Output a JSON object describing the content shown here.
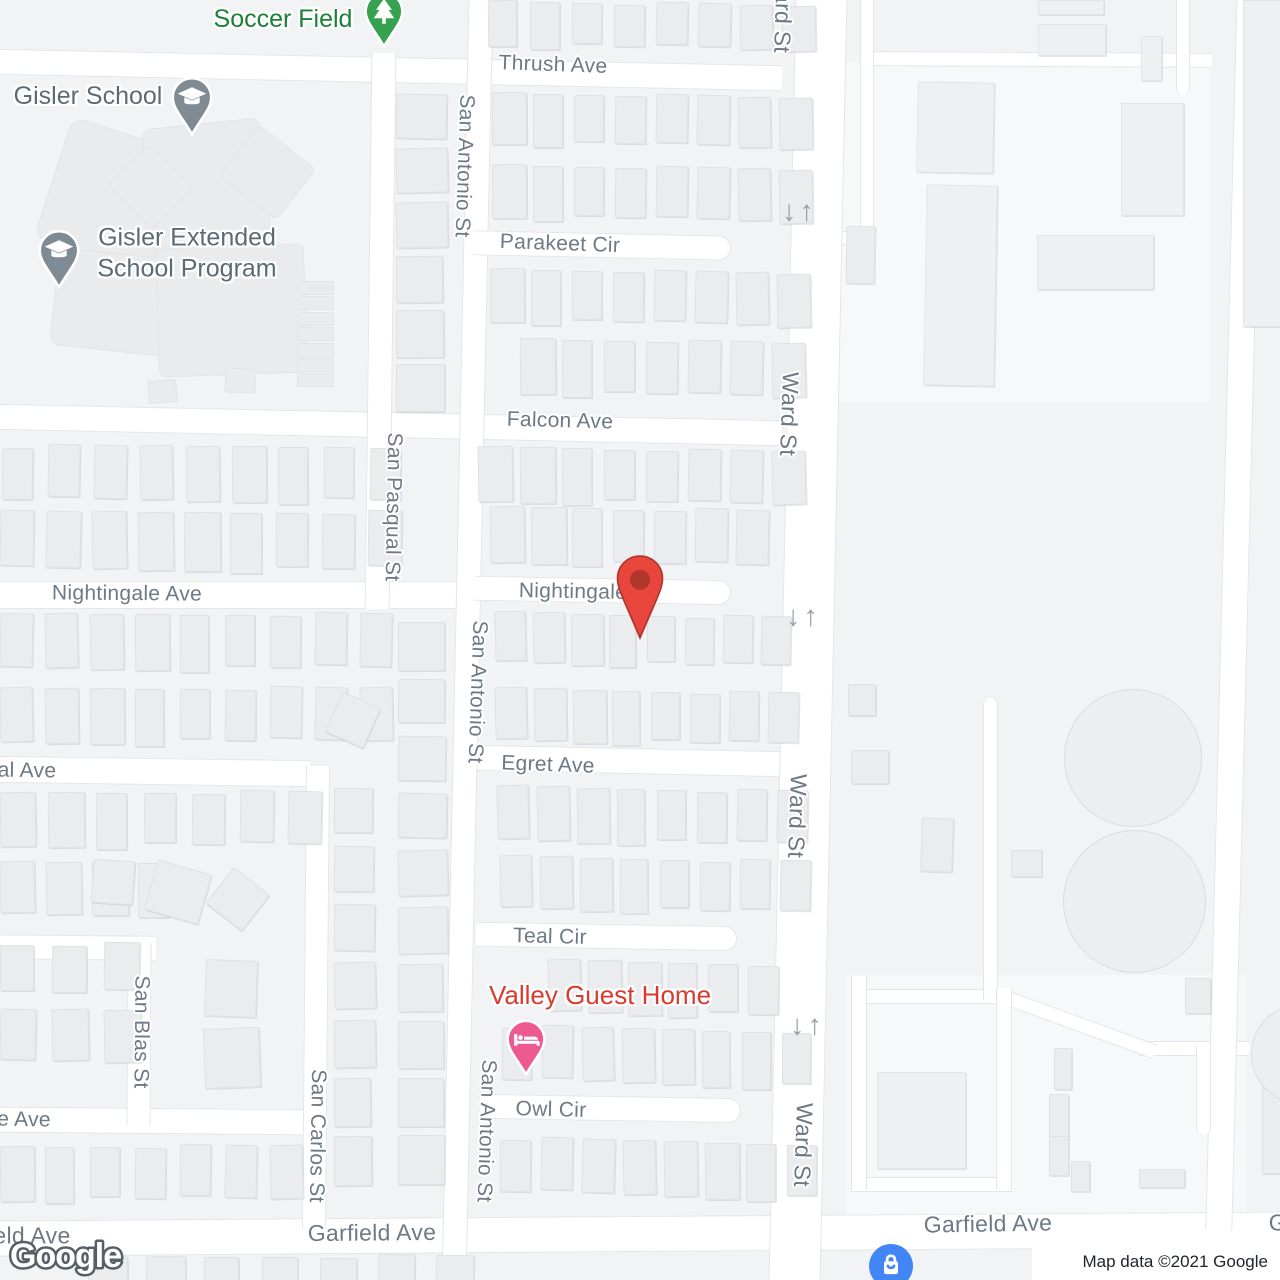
{
  "attribution": "Map data ©2021 Google",
  "watermark": "Google",
  "colors": {
    "land": "#f1f3f5",
    "road": "#ffffff",
    "road_casing": "#e3e6ea",
    "building": "#eaecee",
    "street_label": "#6d7985",
    "park_text": "#1e8038",
    "school_text": "#5b6b76",
    "lodging_text": "#d93a2e",
    "pin_park": "#36a24f",
    "pin_school": "#7e8a94",
    "pin_lodging": "#ec5a90",
    "pin_destination": "#e8453c",
    "pin_destination_inner": "#b0352b",
    "shopping_blue": "#4285f4",
    "arrow": "#9aa0a6"
  },
  "streets": [
    {
      "id": "thrush-ave",
      "text": "Thrush Ave"
    },
    {
      "id": "parakeet-cir",
      "text": "Parakeet Cir"
    },
    {
      "id": "falcon-ave",
      "text": "Falcon Ave"
    },
    {
      "id": "nightingale-ave-west",
      "text": "Nightingale Ave"
    },
    {
      "id": "nightingale-ave-east",
      "text": "Nightingale"
    },
    {
      "id": "egret-ave",
      "text": "Egret Ave"
    },
    {
      "id": "teal-cir",
      "text": "Teal Cir"
    },
    {
      "id": "owl-cir",
      "text": "Owl Cir"
    },
    {
      "id": "al-ave-clipped",
      "text": "al Ave"
    },
    {
      "id": "e-ave-clipped",
      "text": "e Ave"
    },
    {
      "id": "garfield-ave-west-clipped",
      "text": "eld Ave"
    },
    {
      "id": "garfield-ave-center",
      "text": "Garfield Ave"
    },
    {
      "id": "garfield-ave-east",
      "text": "Garfield Ave"
    },
    {
      "id": "garfield-ave-right-clipped",
      "text": "Garfield Ave"
    },
    {
      "id": "san-antonio-st-1",
      "text": "San Antonio St"
    },
    {
      "id": "san-antonio-st-2",
      "text": "San Antonio St"
    },
    {
      "id": "san-antonio-st-3",
      "text": "San Antonio St"
    },
    {
      "id": "san-pasqual-st",
      "text": "San Pasqual St"
    },
    {
      "id": "san-blas-st",
      "text": "San Blas St"
    },
    {
      "id": "san-carlos-st",
      "text": "San Carlos St"
    },
    {
      "id": "ward-st-1",
      "text": "Ward St"
    },
    {
      "id": "ward-st-2",
      "text": "Ward St"
    },
    {
      "id": "ward-st-3",
      "text": "Ward St"
    },
    {
      "id": "ward-st-4",
      "text": "Ward St"
    }
  ],
  "pois": [
    {
      "id": "soccer-field",
      "label": "Soccer Field",
      "icon": "tree-icon",
      "type": "park"
    },
    {
      "id": "gisler-school",
      "label": "Gisler School",
      "icon": "school-icon",
      "type": "school"
    },
    {
      "id": "gisler-extended-school-program",
      "label": "Gisler Extended School Program",
      "icon": "school-icon",
      "type": "school"
    },
    {
      "id": "valley-guest-home",
      "label": "Valley Guest Home",
      "icon": "lodging-icon",
      "type": "lodging"
    },
    {
      "id": "destination",
      "label": "",
      "icon": "destination-pin-icon",
      "type": "destination"
    },
    {
      "id": "shopping",
      "label": "",
      "icon": "shopping-icon",
      "type": "shopping"
    }
  ],
  "traffic_arrows": {
    "down": "↓",
    "up": "↑"
  }
}
